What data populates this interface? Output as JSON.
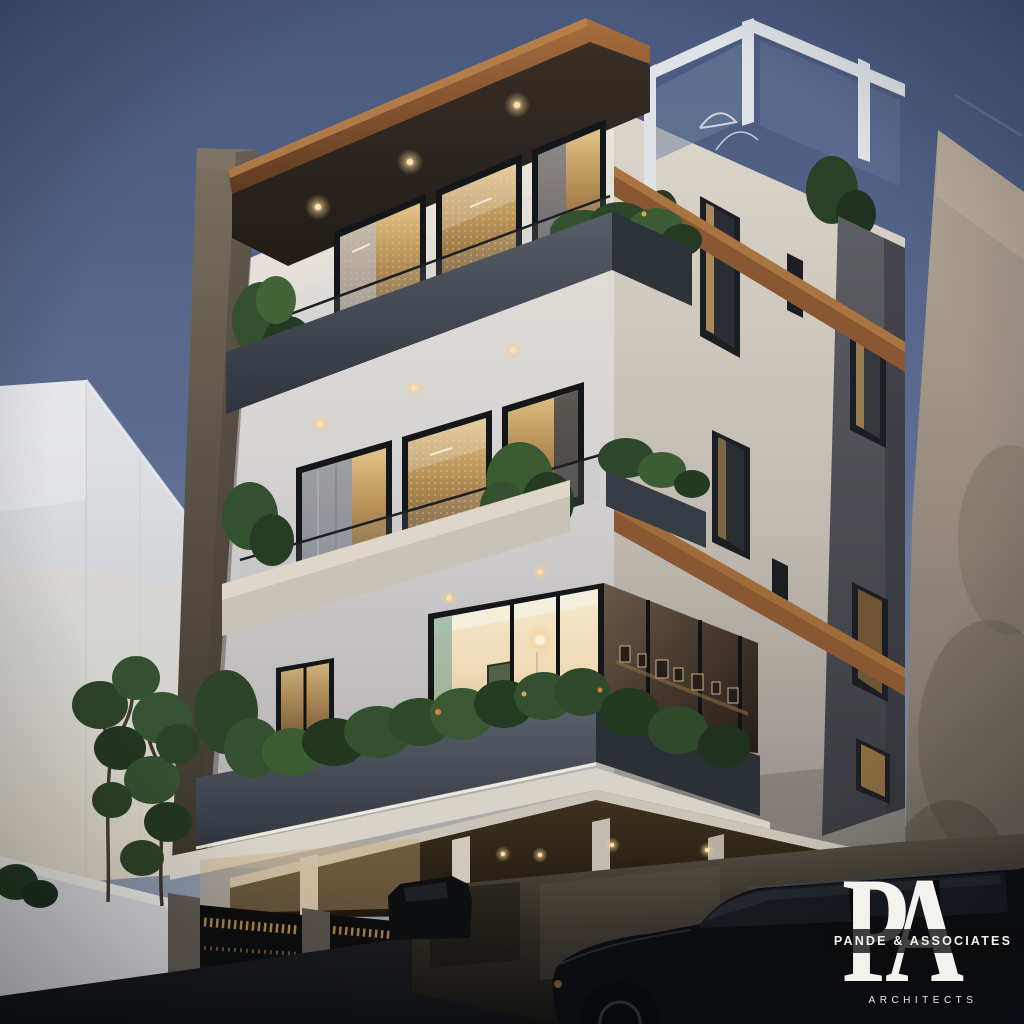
{
  "watermark": {
    "monogram_p": "P",
    "monogram_a": "A",
    "firm_name": "PANDE & ASSOCIATES",
    "subtitle": "ARCHITECTS"
  },
  "palette": {
    "sky_top": "#49597e",
    "sky_horizon": "#98a2b2",
    "wall_white": "#e3ded4",
    "wood_accent": "#8a5733",
    "concrete_dark": "#3f454e",
    "stone_grey": "#55565a",
    "plant_green": "#33502f",
    "warm_light": "#ffe2a8",
    "glass_frame": "#14171a",
    "road_dark": "#1a1b1e",
    "car_black": "#0b0d10",
    "watermark_white": "#f4f2ed"
  }
}
